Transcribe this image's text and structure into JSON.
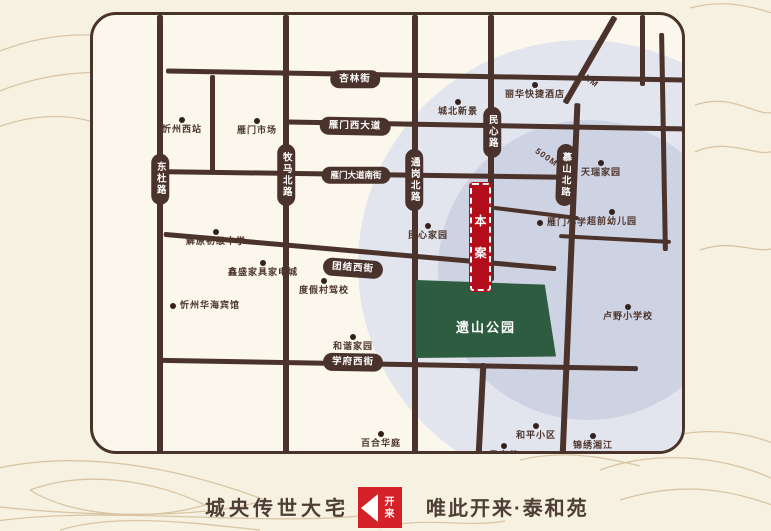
{
  "colors": {
    "page_bg": "#f7f1e2",
    "panel_bg": "#fbf7ec",
    "road_brown": "#4a332c",
    "ring_outer": "#e2e4ee",
    "ring_inner": "#ced3e3",
    "site_red": "#b30d1c",
    "park_green": "#2d5c41",
    "logo_red": "#d42027",
    "label_brown": "#4e362c",
    "contour_tan": "#c2a272"
  },
  "map": {
    "road_badges": [
      {
        "label": "杏林街",
        "x": 262,
        "y": 64,
        "orient": "h",
        "rot": 0
      },
      {
        "label": "雁门西大道",
        "x": 262,
        "y": 111,
        "orient": "h",
        "rot": 1
      },
      {
        "label": "雁门大道南街",
        "x": 263,
        "y": 160,
        "orient": "h",
        "rot": 0,
        "small": true
      },
      {
        "label": "团结西街",
        "x": 260,
        "y": 253,
        "orient": "h",
        "rot": 4
      },
      {
        "label": "学府西街",
        "x": 260,
        "y": 347,
        "orient": "h",
        "rot": 1
      },
      {
        "label": "东杜路",
        "x": 67,
        "y": 164,
        "orient": "v",
        "rot": 0
      },
      {
        "label": "牧马北路",
        "x": 193,
        "y": 160,
        "orient": "v",
        "rot": 0
      },
      {
        "label": "通岗北路",
        "x": 321,
        "y": 165,
        "orient": "v",
        "rot": 0
      },
      {
        "label": "民心路",
        "x": 399,
        "y": 117,
        "orient": "v",
        "rot": 0
      },
      {
        "label": "慕山北路",
        "x": 472,
        "y": 160,
        "orient": "v",
        "rot": 2
      }
    ],
    "distance_labels": [
      {
        "label": "1KM",
        "x": 486,
        "y": 59,
        "rot": 38
      },
      {
        "label": "500M",
        "x": 441,
        "y": 137,
        "rot": 35
      }
    ],
    "landmarks": [
      {
        "label": "忻州西站",
        "x": 89,
        "y": 105,
        "layout": "dot-top"
      },
      {
        "label": "雁门市场",
        "x": 164,
        "y": 106,
        "layout": "dot-top"
      },
      {
        "label": "城北新景",
        "x": 365,
        "y": 87,
        "layout": "dot-top"
      },
      {
        "label": "丽华快捷酒店",
        "x": 442,
        "y": 70,
        "layout": "dot-top"
      },
      {
        "label": "天瑞家园",
        "x": 508,
        "y": 148,
        "layout": "dot-top"
      },
      {
        "label": "超前幼儿园",
        "x": 519,
        "y": 197,
        "layout": "dot-top"
      },
      {
        "label": "雁门小学",
        "x": 447,
        "y": 208,
        "layout": "dot-left"
      },
      {
        "label": "民心家园",
        "x": 335,
        "y": 211,
        "layout": "dot-top"
      },
      {
        "label": "卢野小学校",
        "x": 535,
        "y": 292,
        "layout": "dot-top"
      },
      {
        "label": "解原初级中学",
        "x": 123,
        "y": 217,
        "layout": "dot-top"
      },
      {
        "label": "鑫盛家具家电城",
        "x": 170,
        "y": 248,
        "layout": "dot-top"
      },
      {
        "label": "度假村驾校",
        "x": 231,
        "y": 266,
        "layout": "dot-top"
      },
      {
        "label": "忻州华海宾馆",
        "x": 80,
        "y": 291,
        "layout": "dot-left"
      },
      {
        "label": "和谐家园",
        "x": 260,
        "y": 322,
        "layout": "dot-top"
      },
      {
        "label": "百合华庭",
        "x": 288,
        "y": 419,
        "layout": "dot-top"
      },
      {
        "label": "和平小区",
        "x": 443,
        "y": 411,
        "layout": "dot-top"
      },
      {
        "label": "景泰苑",
        "x": 411,
        "y": 431,
        "layout": "dot-top"
      },
      {
        "label": "锦绣湘江",
        "x": 500,
        "y": 421,
        "layout": "dot-top"
      }
    ],
    "site": {
      "chars": [
        "本",
        "案"
      ]
    },
    "park": {
      "label": "遗山公园"
    }
  },
  "footer": {
    "slogan_left": "城央传世大宅",
    "logo_chars": "开来",
    "slogan_right": "唯此开来·泰和苑"
  }
}
